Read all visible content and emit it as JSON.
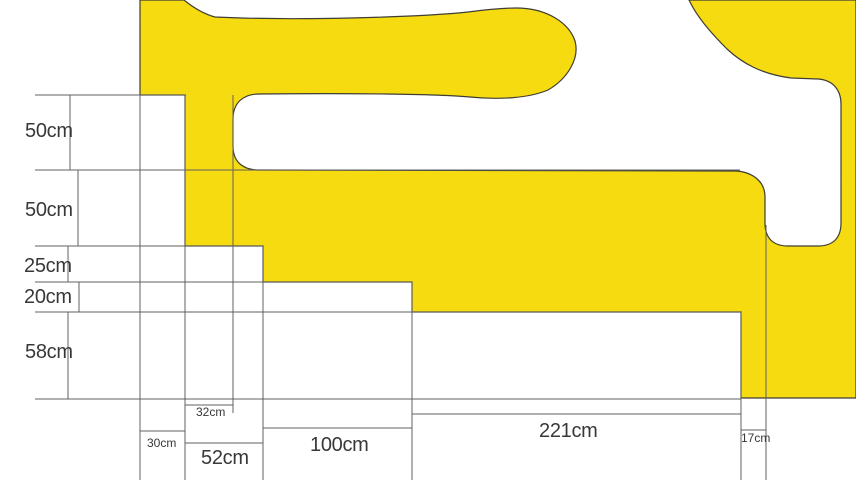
{
  "drawing": {
    "type": "dimensioned-technical-drawing",
    "background_color": "#FFFFFF",
    "shape": {
      "name": "yellow-freeform-profile",
      "fill": "#F6DB10",
      "outline": "#3E3E35"
    },
    "annotation": {
      "line_color": "#606060",
      "text_color": "#383838"
    },
    "vertical_dimensions": [
      {
        "label": "50cm",
        "value_cm": 50
      },
      {
        "label": "50cm",
        "value_cm": 50
      },
      {
        "label": "25cm",
        "value_cm": 25
      },
      {
        "label": "20cm",
        "value_cm": 20
      },
      {
        "label": "58cm",
        "value_cm": 58
      }
    ],
    "horizontal_dimensions": [
      {
        "label": "30cm",
        "value_cm": 30
      },
      {
        "label": "52cm",
        "value_cm": 52
      },
      {
        "label": "32cm",
        "value_cm": 32
      },
      {
        "label": "100cm",
        "value_cm": 100
      },
      {
        "label": "221cm",
        "value_cm": 221
      },
      {
        "label": "17cm",
        "value_cm": 17
      }
    ]
  }
}
